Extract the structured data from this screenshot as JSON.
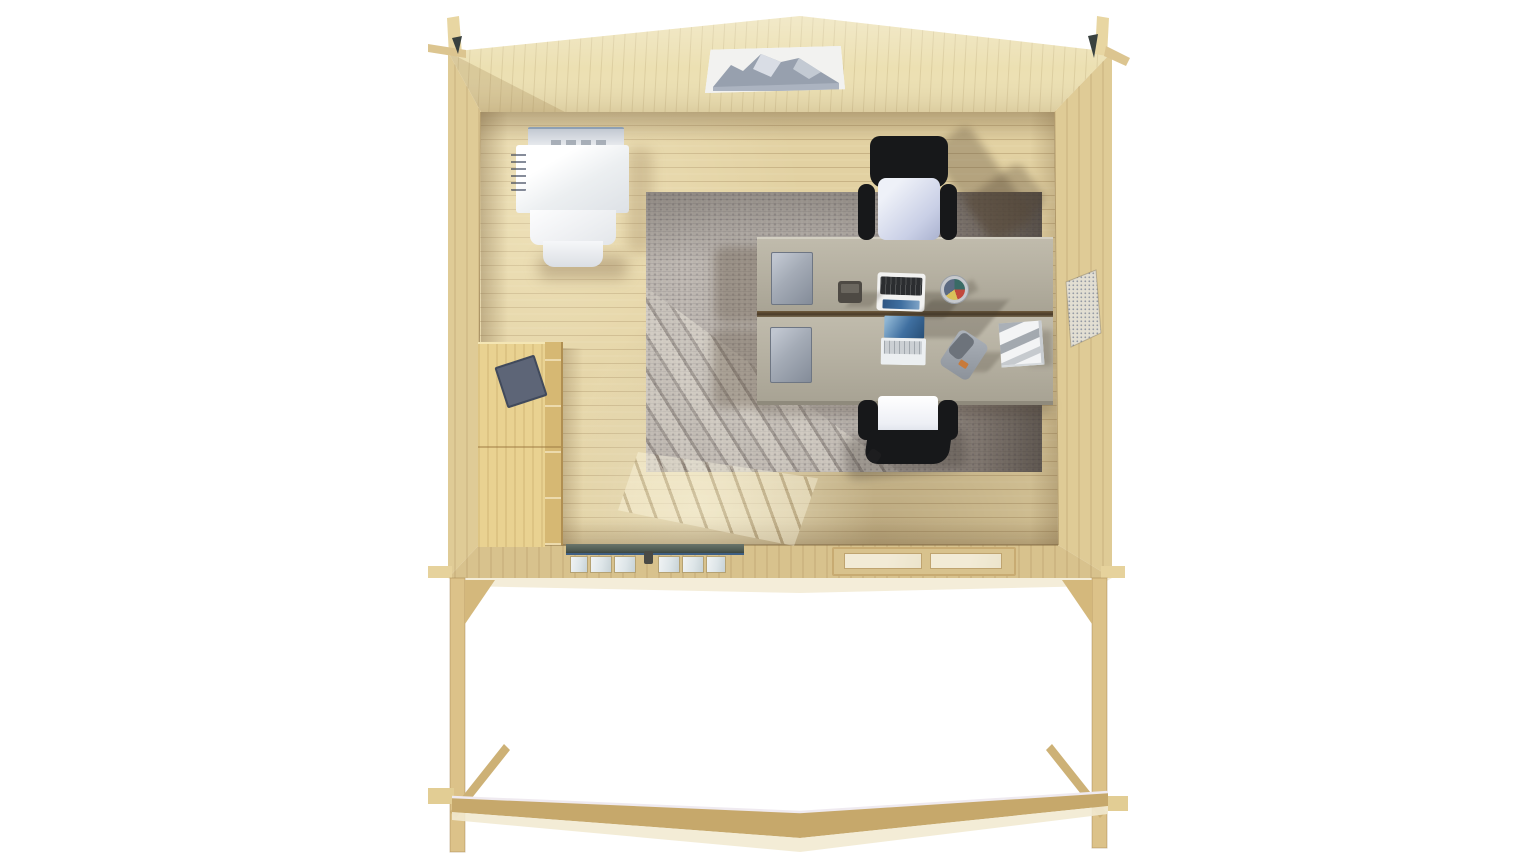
{
  "scene": {
    "title": "Wooden garden office cabin — overhead 3D interior view",
    "background": "#ffffff"
  },
  "colors": {
    "background": "#ffffff",
    "wood_back_wall": "#ece0b2",
    "wood_side_wall": "#dfcb96",
    "wood_floor": "#e2d1a2",
    "wood_front_wall": "#d8c28d",
    "wood_cabinet": "#e9d291",
    "wood_cabinet_side": "#d6b873",
    "wood_beam": "#c6a86b",
    "beam_highlight": "#f2ead2",
    "desk_top": "#b6b1a2",
    "desk_gap": "#4a3b28",
    "pedestal": "#a4abb6",
    "rug_base": "#aea7a1",
    "rug_dark": "#4e463f",
    "chair_frame": "#17181a",
    "chair_seat_top": "#c9cfe6",
    "chair_seat_bottom": "#edeff5",
    "unit_white": "#f5f6f8",
    "door_header": "#4e5a52",
    "door_glass": "#dde5e8",
    "window_pane": "#ece4cc",
    "vent_base": "#e2ded2",
    "vent_dot": "#949aa4",
    "poster_blue": "#97a0b0",
    "book_blue": "#5d6577",
    "picture_sky": "#f2f2f0",
    "picture_mountain": "#97a0ae",
    "laptop_screen_blue": "#3f6fa0",
    "laptop_key_dark": "#2b2d30"
  },
  "objects": {
    "back_wall": "Back gable wall",
    "left_wall": "Left side wall",
    "right_wall": "Right side wall",
    "floor": "Wood plank floor",
    "front_wall": "Front wall (top view)",
    "picture": "Mountain landscape picture",
    "heater": "White wall unit",
    "poster": "Small wall poster",
    "cabinet": "Tall wooden cabinet",
    "book": "Blue folder on cabinet",
    "rug": "Large grey rug",
    "desk_far": "Far office desk",
    "desk_near": "Near office desk",
    "pedestal_far": "Drawer pedestal (far desk)",
    "pedestal_near": "Drawer pedestal (near desk)",
    "laptop_far": "Open laptop (far desk)",
    "laptop_near": "Open laptop (near desk)",
    "desk_phone": "Desk telephone",
    "smartphone": "Phone on near desk",
    "pen_cup": "Pen cup",
    "papers": "Stack of papers",
    "chair_far": "Office chair (far)",
    "chair_near": "Office chair (near)",
    "vent": "Wall ventilation grille",
    "door": "Glazed double door (top view)",
    "door_handle": "Door handle",
    "window": "Front window (top view)",
    "post_left": "Left porch post",
    "post_right": "Right porch post",
    "brace_left": "Left diagonal brace",
    "brace_right": "Right diagonal brace",
    "deck_beam": "Front deck edge beam",
    "corner_left": "Left corner log joint",
    "corner_right": "Right corner log joint"
  }
}
